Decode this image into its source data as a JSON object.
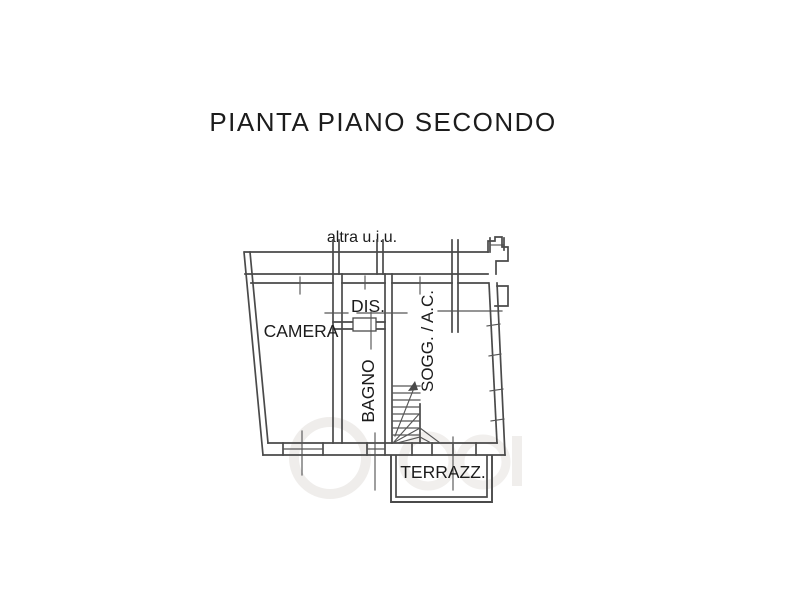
{
  "page": {
    "title": "PIANTA PIANO SECONDO",
    "background": "#ffffff",
    "line_color": "#4a4a4a"
  },
  "plan": {
    "annotation": "altra u.i.u.",
    "rooms": {
      "camera": "CAMERA",
      "dis": "DIS.",
      "bagno": "BAGNO",
      "sogg": "SOGG. / A.C.",
      "terrazzo": "TERRAZZ."
    }
  },
  "watermark": {
    "color": "#efedeb"
  }
}
